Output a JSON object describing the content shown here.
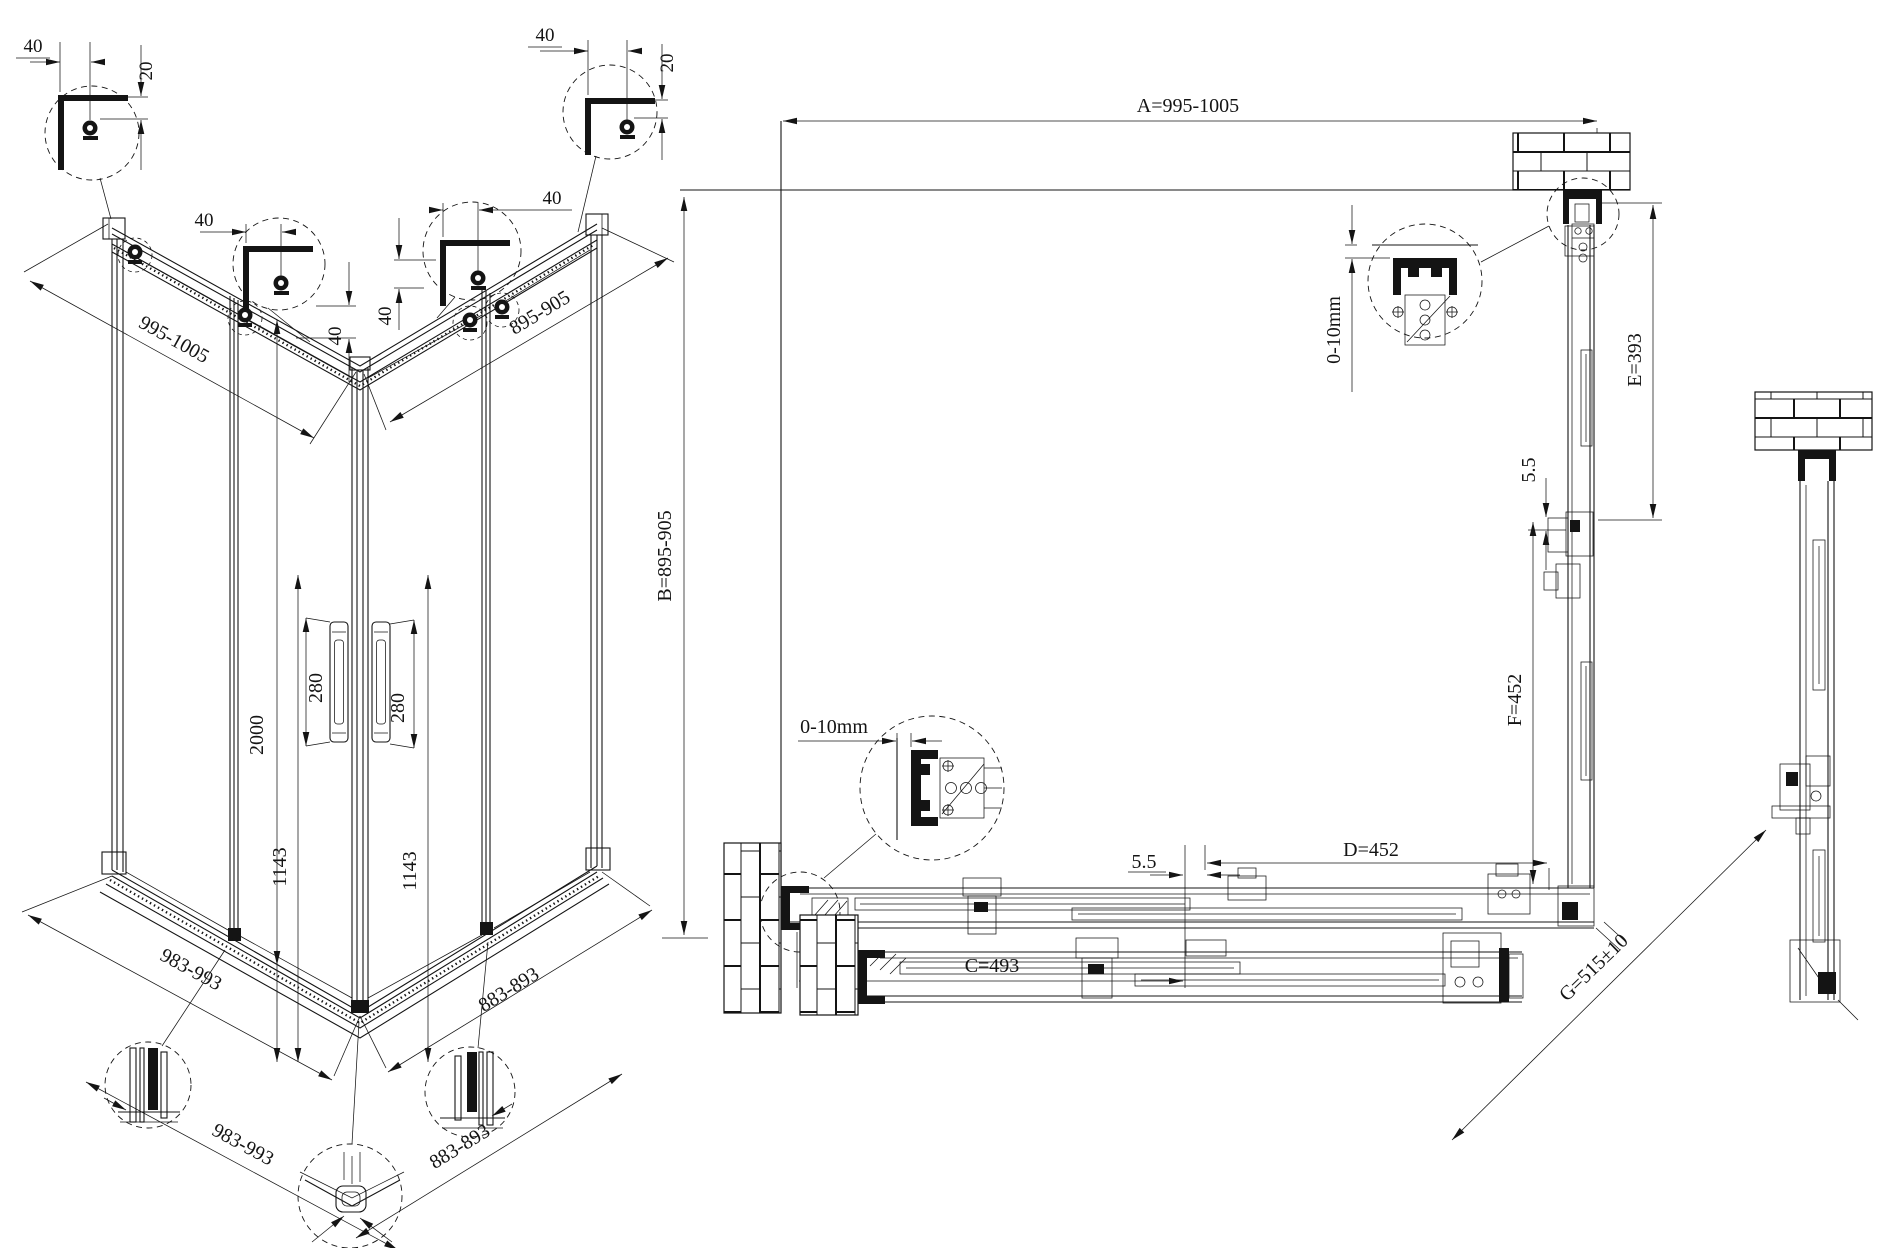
{
  "drawing": {
    "isometric": {
      "corner_details": [
        {
          "offset": "40",
          "gap": "20"
        },
        {
          "offset": "40",
          "side_offset": "40"
        },
        {
          "offset": "40",
          "side_offset": "40"
        },
        {
          "offset": "40",
          "gap": "20"
        }
      ],
      "top_width": "995-1005",
      "top_depth": "895-905",
      "height": "2000",
      "handle_left": "280",
      "handle_right": "280",
      "glass_left": "1143",
      "glass_right": "1143",
      "base_width": "983-993",
      "base_width_outer": "983-993",
      "base_depth": "883-893",
      "base_depth_outer": "883-893"
    },
    "plan": {
      "dim_a": "A=995-1005",
      "dim_b": "B=895-905",
      "dim_c": "C=493",
      "dim_d": "D=452",
      "dim_e": "E=393",
      "dim_f": "F=452",
      "dim_g": "G=515±10",
      "gap_right": "5.5",
      "gap_bottom": "5.5",
      "wall_adjust_top": "0-10mm",
      "wall_adjust_left": "0-10mm"
    }
  }
}
